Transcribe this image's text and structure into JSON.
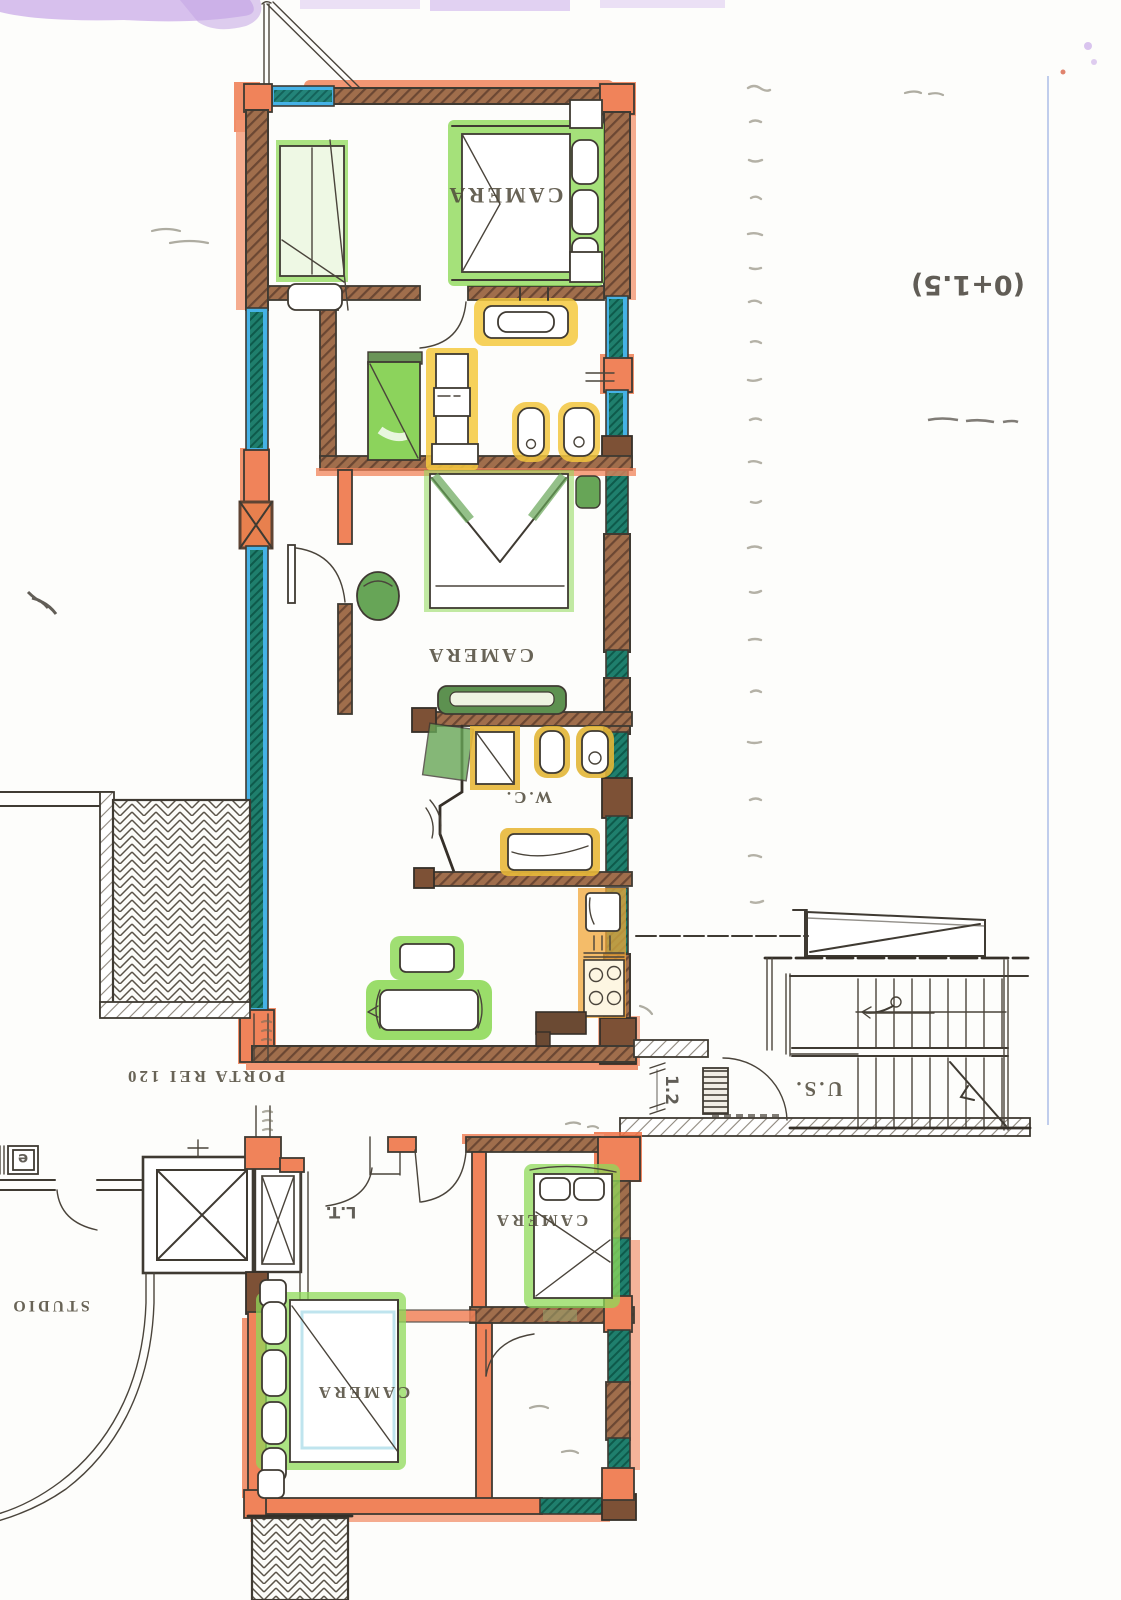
{
  "plan": {
    "room_labels": {
      "camera_top": "CAMERA",
      "camera_middle": "CAMERA",
      "camera_lower_right": "CAMERA",
      "camera_lower_left": "CAMERA",
      "wc": "W.C.",
      "studio": "STUDIO"
    },
    "annotations": {
      "fire_door": "PORTA REI 120",
      "safety_exit": "U.S.",
      "door_width": "1.2",
      "hall": "L.T.",
      "level": "(0+1.5)",
      "utility_box": "e"
    },
    "colors": {
      "wall_highlight": "#f0835a",
      "masonry_brown": "#a06e4c",
      "window_blue": "#45b2e6",
      "window_teal": "#1f7f6d",
      "furniture_green": "#8fd95a",
      "fixture_yellow": "#f5c93e",
      "ink": "#3f3a32",
      "scan_smudge": "#cdb0ea"
    }
  }
}
